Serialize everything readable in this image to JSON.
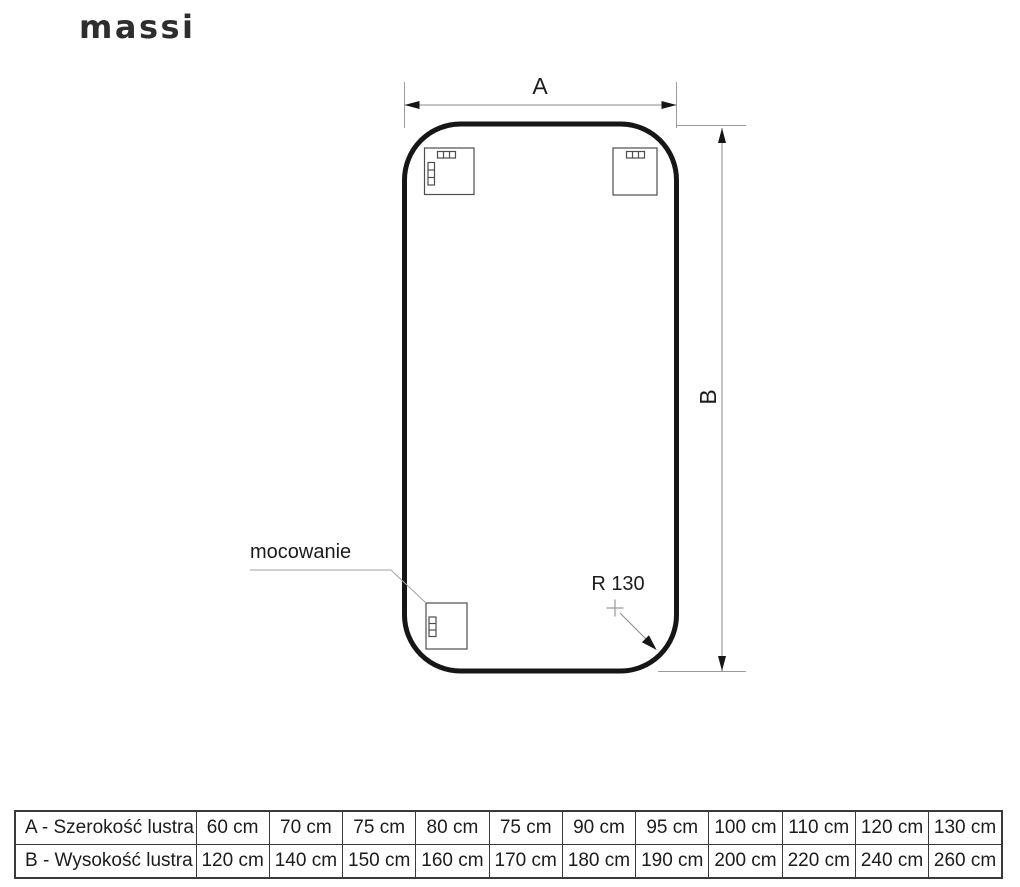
{
  "brand": {
    "logo_text": "massi"
  },
  "diagram": {
    "width_label": "A",
    "height_label": "B",
    "mount_label": "mocowanie",
    "radius_label": "R 130"
  },
  "table": {
    "rows": [
      {
        "header": "A - Szerokość lustra",
        "values": [
          "60 cm",
          "70 cm",
          "75 cm",
          "80 cm",
          "75 cm",
          "90 cm",
          "95 cm",
          "100 cm",
          "110 cm",
          "120 cm",
          "130 cm"
        ]
      },
      {
        "header": "B - Wysokość lustra",
        "values": [
          "120 cm",
          "140 cm",
          "150 cm",
          "160 cm",
          "170 cm",
          "180 cm",
          "190 cm",
          "200 cm",
          "220 cm",
          "240 cm",
          "260 cm"
        ]
      }
    ]
  },
  "colors": {
    "outline": "#161616",
    "dimension_line": "#8a8a8a",
    "text": "#1c1c1c"
  }
}
